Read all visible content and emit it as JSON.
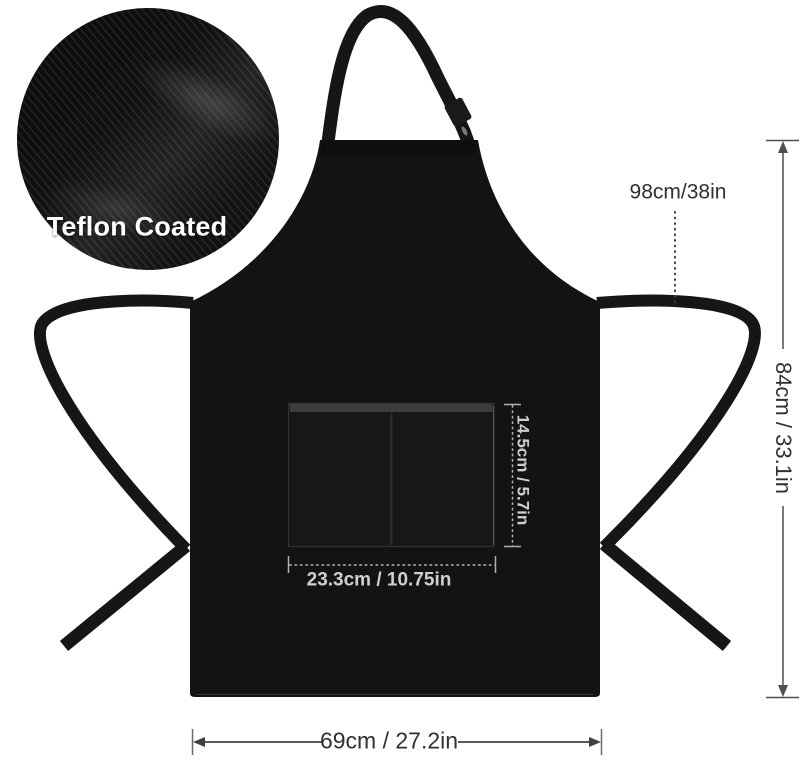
{
  "callout": {
    "label": "Teflon Coated"
  },
  "dimensions": {
    "neck_strap": {
      "label": "98cm/38in"
    },
    "body_height": {
      "label": "84cm / 33.1in"
    },
    "pocket_height": {
      "label": "14.5cm / 5.7in"
    },
    "pocket_width": {
      "label": "23.3cm / 10.75in"
    },
    "body_width": {
      "label": "69cm / 27.2in"
    }
  },
  "colors": {
    "background": "#ffffff",
    "apron_fabric": "#131313",
    "strap": "#161616",
    "dark_dimension_text": "#303030",
    "dark_dimension_line": "#4f4f4f",
    "light_dimension_text": "#cfcfcf",
    "light_dimension_line": "#b0b0b0",
    "callout_text": "#ffffff"
  }
}
